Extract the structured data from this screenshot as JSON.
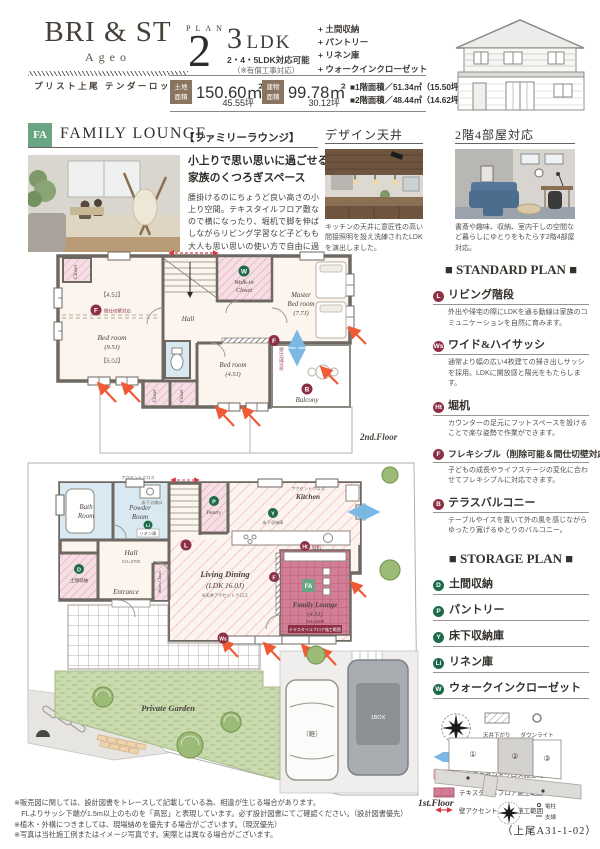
{
  "header": {
    "brand": "BRI & ST",
    "brand_sub": "Ageo",
    "brand_caption": "プリスト上尾 テンダーロッジ",
    "plan_label": "PLAN",
    "plan_number": "2",
    "ldk_number": "3",
    "ldk_unit": "LDK",
    "ldk_sub": "2・4・5LDK対応可能",
    "ldk_note": "（※有償工事対応）",
    "features": [
      "+ 土間収納",
      "+ パントリー",
      "+ リネン庫",
      "+ ウォークインクローゼット"
    ],
    "land_label_top": "土地",
    "land_label_bottom": "面積",
    "land_value": "150.60㎡",
    "land_tsubo": "45.55坪",
    "bldg_label_top": "建物",
    "bldg_label_bottom": "面積",
    "bldg_value": "99.78㎡",
    "bldg_tsubo": "30.12坪",
    "floor1_area": "■1階面積／51.34㎡（15.50坪）",
    "floor2_area": "■2階面積／48.44㎡（14.62坪）"
  },
  "feature": {
    "badge": "FA",
    "title_en": "FAMILY LOUNGE",
    "title_jp": "【ファミリーラウンジ】",
    "heading_line1": "小上りで思い思いに過ごせる",
    "heading_line2": "家族のくつろぎスペース",
    "body": "腰掛けるのにちょうど良い高さの小上り空間。テキスタイルフロア敷なので横になったり、堀机で脚を伸ばしながらリビング学習など子どもも大人も思い思いの使い方で自由に過ごせます。"
  },
  "photo_sections": [
    {
      "title": "デザイン天井",
      "caption": "キッチンの天井に意匠性の高い間接照明を設え洗練されたLDKを演出しました。"
    },
    {
      "title": "2階4部屋対応",
      "caption": "書斎や趣味、収納、室内干しの空間など暮らしにゆとりをもたらす2階4部屋対応。"
    }
  ],
  "standard_plan": {
    "title": "■ STANDARD PLAN ■",
    "items": [
      {
        "badge": "L",
        "name": "リビング階段",
        "desc": "外出や帰宅の際にLDKを通る動線は家族のコミュニケーションを自然に育みます。"
      },
      {
        "badge": "Ws",
        "name": "ワイド&ハイサッシ",
        "desc": "通常より幅の広い4枚建ての掃き出しサッシを採用。LDKに開放感と陽光をもたらします。"
      },
      {
        "badge": "Ht",
        "name": "堀机",
        "desc": "カウンターの足元にフットスペースを設けることで楽な姿勢で作業ができます。"
      },
      {
        "badge": "F",
        "name": "フレキシブル（削除可能＆間仕切壁対応）",
        "desc": "子どもの成長やライフステージの変化に合わせてフレキシブルに対応できます。"
      },
      {
        "badge": "B",
        "name": "テラスバルコニー",
        "desc": "テーブルやイスを置いて外の風を感じながらゆったり寛げるゆとりのバルコニー。"
      }
    ]
  },
  "storage_plan": {
    "title": "■ STORAGE PLAN ■",
    "items": [
      {
        "badge": "D",
        "name": "土間収納"
      },
      {
        "badge": "P",
        "name": "パントリー"
      },
      {
        "badge": "Y",
        "name": "床下収納庫"
      },
      {
        "badge": "Li",
        "name": "リネン庫"
      },
      {
        "badge": "W",
        "name": "ウォークインクローゼット"
      }
    ]
  },
  "legend": {
    "ceiling_drop": "天井下がり",
    "downlight": "ダウンライト",
    "flow": "動線",
    "sunlight": "陽当り",
    "ceiling_accent": "天井アクセントクロス施工範囲",
    "textile_floor": "テキスタイルフロア施工範囲",
    "wall_accent": "壁アクセントクロス施工範囲"
  },
  "floor2": {
    "floor_label": "2nd.Floor",
    "closet_nw": "Closet",
    "size_a": "【4.5J】",
    "size_b": "【5.0J】",
    "partition_note": "間仕切壁対応",
    "bedroom1_name": "Bed room",
    "bedroom1_size": "(9.5J)",
    "hall": "Hall",
    "wic_line1": "Walk-in",
    "wic_line2": "Closet",
    "master_line1": "Master",
    "master_line2": "Bed room",
    "master_line3": "(7.7J)",
    "bedroom2_name": "Bed room",
    "bedroom2_size": "(4.5J)",
    "closet_s1": "Closet",
    "closet_s2": "Closet",
    "balcony": "Balcony"
  },
  "floor1": {
    "floor_label": "1st.Floor",
    "bath_line1": "Bath",
    "bath_line2": "Room",
    "powder_line1": "Powder",
    "powder_line2": "Room",
    "inspection_hatch": "床下点検口",
    "linen": "リネン庫",
    "hall": "Hall",
    "hall_ch": "CH=2700",
    "doma": "土間収納",
    "entrance": "Entrance",
    "shoes": "Shoes Closet",
    "pantry": "Pantry",
    "kitchen": "Kitchen",
    "accent_label": "アクセントクロス",
    "underfloor": "床下収納庫",
    "desk": "堀机",
    "living_line1": "Living Dining",
    "living_line2": "(LDK 16.0J)",
    "living_note": "※天井アクセントクロス",
    "fl_line1": "Family Lounge",
    "fl_line2": "(4.5J)",
    "fl_ch": "CH=2100",
    "fl_range": "テキスタイルフロア施工範囲",
    "garden": "Private Garden",
    "car_small": "（軽）",
    "car_box": "1BOX"
  },
  "badges": {
    "l": "L",
    "ws": "Ws",
    "ht": "Ht",
    "f": "F",
    "b": "B",
    "d": "D",
    "p": "P",
    "y": "Y",
    "li": "Li",
    "w": "W",
    "fa": "FA"
  },
  "site_map": {
    "lot1": "①",
    "lot2": "②",
    "lot3": "③",
    "pole": "電柱",
    "wire": "支線",
    "code": "（上尾A31-1-02）"
  },
  "footnotes": [
    "※販売図に関しては、設計図書をトレースして記載している為、相違が生じる場合があります。",
    "　FLよりサッシ下端が1.5m以上のものを「高窓」と表現しています。必ず設計図書にてご確認ください。（設計図書優先）",
    "※植木・外構につきましては、現場納めを優先する場合がございます。（現況優先）",
    "※写真は当社施工例またはイメージ写真です。実際とは異なる場合がございます。"
  ],
  "colors": {
    "badge_red": "#8e3044",
    "badge_green": "#1e6b4c",
    "fa_green": "#69a583",
    "area_badge_brown": "#8a7460",
    "accent_pink": "#ef9fc4",
    "textile_pink": "#d27e97",
    "flow_blue": "#7cb8e4",
    "sunlight_red": "#ef5b35"
  }
}
